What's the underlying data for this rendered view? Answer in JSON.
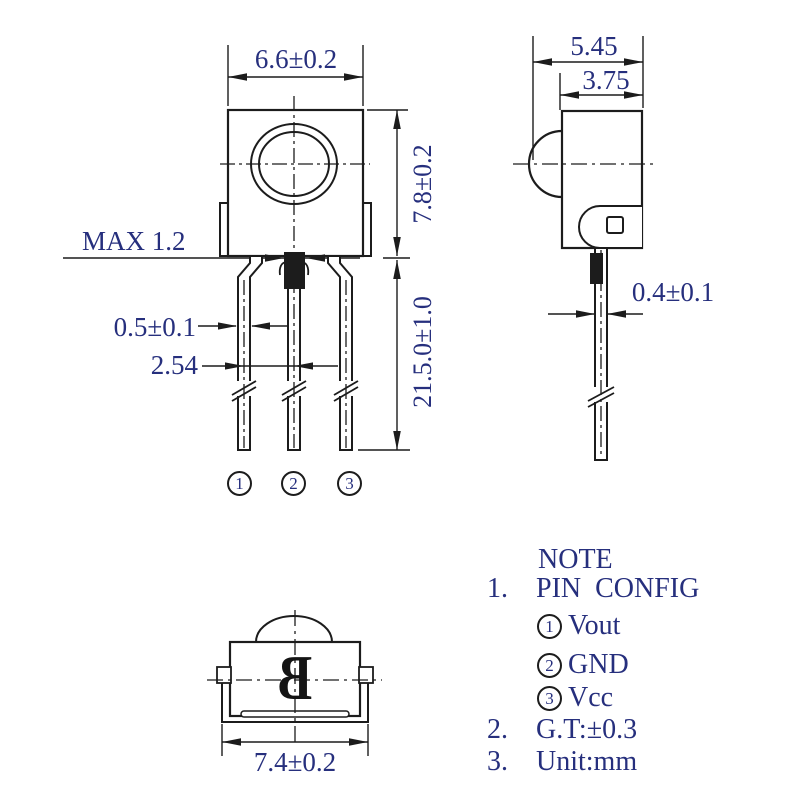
{
  "drawing": {
    "front_view": {
      "width_dim": "6.6±0.2",
      "height_dim": "7.8±0.2",
      "standoff_dim": "MAX 1.2",
      "lead_width_dim": "0.5±0.1",
      "lead_pitch_dim": "2.54",
      "lead_length_dim": "21.5.0±1.0",
      "pins": [
        "1",
        "2",
        "3"
      ]
    },
    "side_view": {
      "total_depth_dim": "5.45",
      "body_depth_dim": "3.75",
      "lead_thickness_dim": "0.4±0.1"
    },
    "bottom_view": {
      "base_width_dim": "7.4±0.2",
      "marking": "B"
    }
  },
  "note": {
    "title": "NOTE",
    "item1_index": "1.",
    "item1_text": "PIN  CONFIG",
    "pin_config": [
      {
        "num": "1",
        "signal": "Vout"
      },
      {
        "num": "2",
        "signal": "GND"
      },
      {
        "num": "3",
        "signal": "Vcc"
      }
    ],
    "item2_index": "2.",
    "item2_text": "G.T:±0.3",
    "item3_index": "3.",
    "item3_text": "Unit:mm"
  },
  "colors": {
    "line": "#1c1c1c",
    "text": "#262f7d"
  }
}
